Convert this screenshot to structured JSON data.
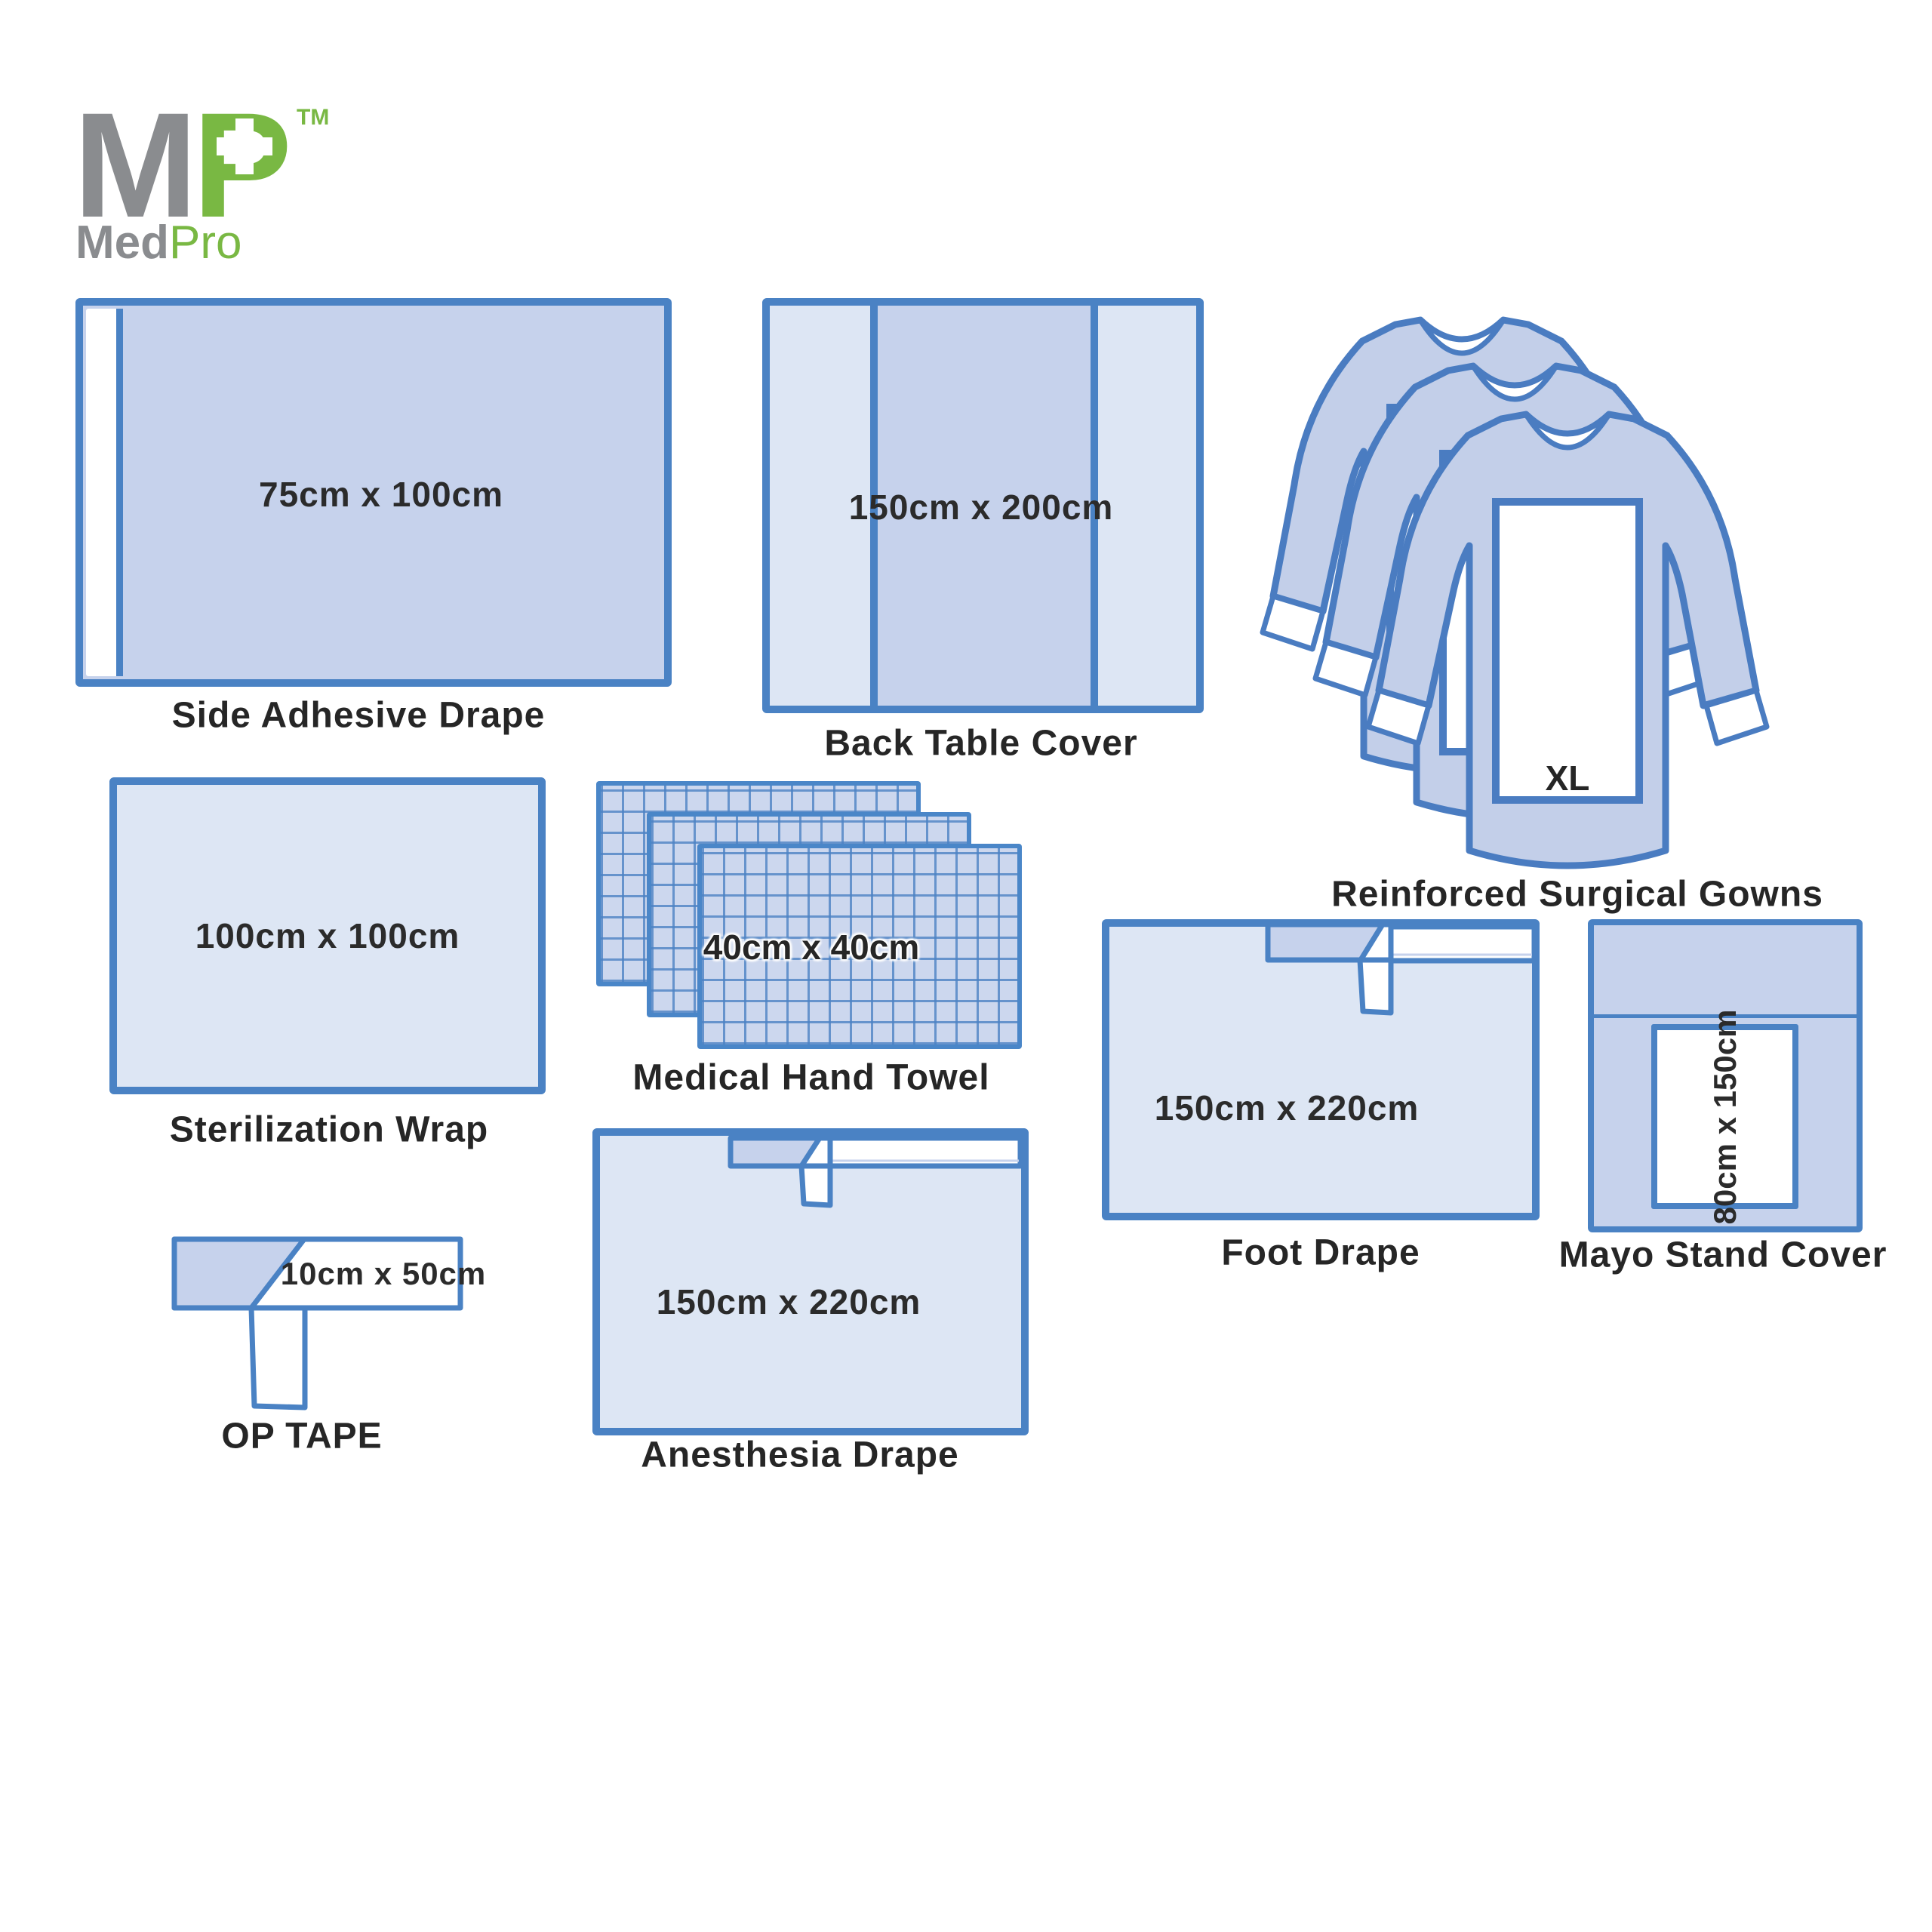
{
  "brand": {
    "m": "M",
    "p": "P",
    "tm": "TM",
    "med": "Med",
    "pro": "Pro"
  },
  "colors": {
    "outline_blue": "#4a82c4",
    "fill_mid": "#c6d2ec",
    "fill_light": "#dde6f4",
    "gown_fill": "#c3cfe9",
    "towel_bg": "#ccd7ee",
    "logo_gray": "#8a8c8f",
    "logo_green": "#79b843",
    "text": "#262626",
    "white": "#ffffff"
  },
  "items": {
    "side_adhesive": {
      "dimensions": "75cm x 100cm",
      "caption": "Side Adhesive Drape"
    },
    "back_table": {
      "dimensions": "150cm x 200cm",
      "caption": "Back Table Cover"
    },
    "gowns": {
      "size_label": "XL",
      "caption": "Reinforced Surgical Gowns"
    },
    "sterilization": {
      "dimensions": "100cm x 100cm",
      "caption": "Sterilization Wrap"
    },
    "hand_towel": {
      "dimensions": "40cm x 40cm",
      "caption": "Medical Hand Towel"
    },
    "op_tape": {
      "dimensions": "10cm x 50cm",
      "caption": "OP TAPE"
    },
    "anesthesia": {
      "dimensions": "150cm x 220cm",
      "caption": "Anesthesia Drape"
    },
    "foot": {
      "dimensions": "150cm x 220cm",
      "caption": "Foot Drape"
    },
    "mayo": {
      "dimensions": "80cm x 150cm",
      "caption": "Mayo Stand Cover"
    }
  }
}
